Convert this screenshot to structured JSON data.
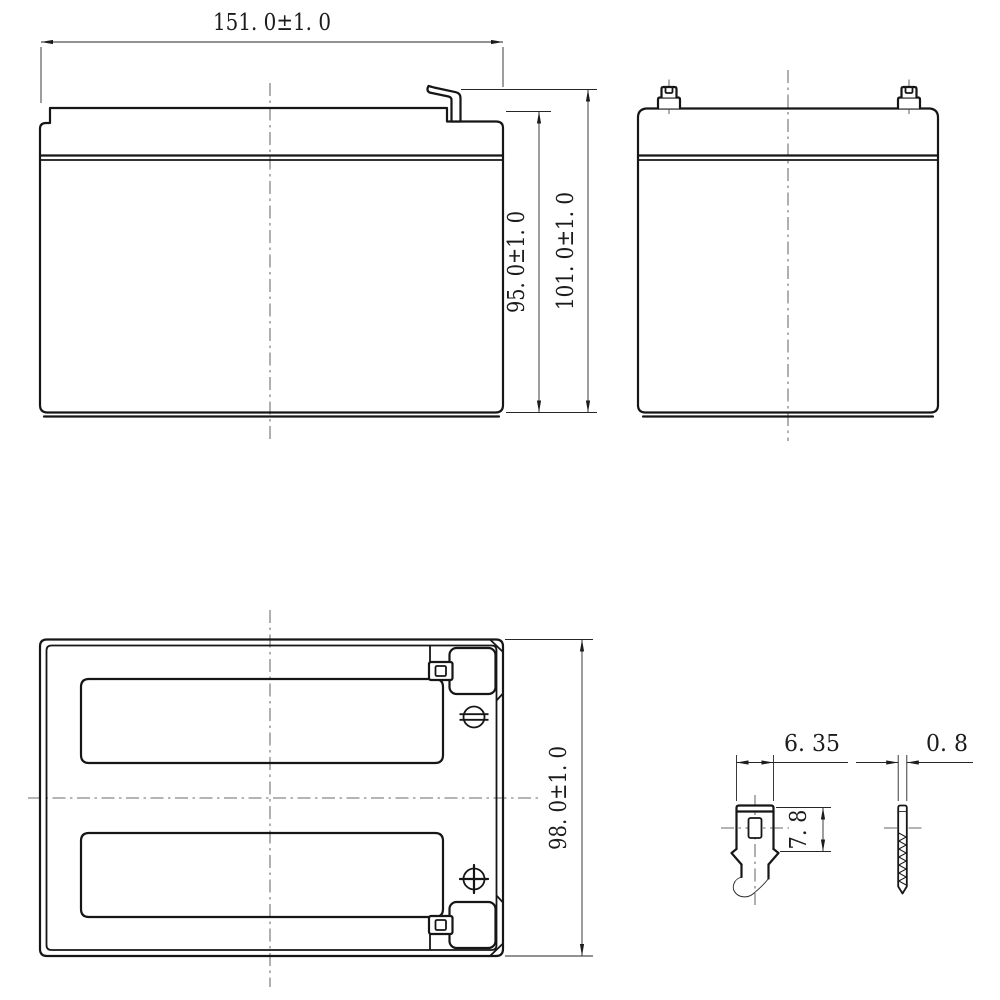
{
  "page": {
    "background": "#ffffff",
    "line_color": "#1c1c1c"
  },
  "front_view": {
    "width_dim": "151. 0±1. 0",
    "case_height_dim": "95. 0±1. 0",
    "overall_height_dim": "101. 0±1. 0"
  },
  "top_view": {
    "depth_dim": "98. 0±1. 0"
  },
  "terminal_detail": {
    "tab_width_dim": "6. 35",
    "tab_shoulder_height_dim": "7. 8",
    "tab_thickness_dim": "0. 8"
  }
}
